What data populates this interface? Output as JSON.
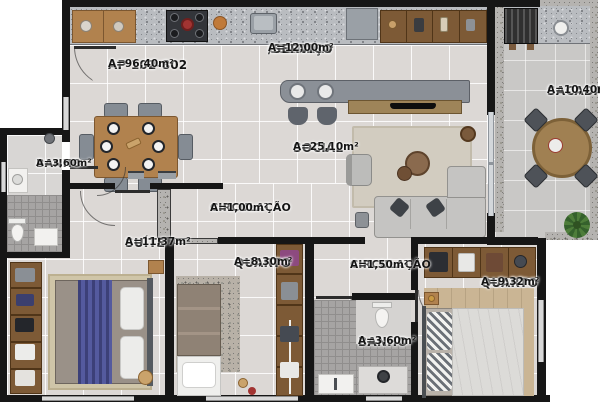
{
  "unit": {
    "code": "AP 102-802",
    "area": "A=96,40m²"
  },
  "rooms": {
    "cozinha": {
      "name": "COZINHA",
      "name2": "/SERVIÇO",
      "area": "A=12,00m²"
    },
    "social": {
      "name": "SOCIAL",
      "area": "A=25,10m²"
    },
    "sacada": {
      "name": "SACADA",
      "area": "A=10,40m²"
    },
    "banho_esq": {
      "name": "BANHO",
      "area": "A=3,60m²"
    },
    "circulacao1": {
      "name": "CIRCULAÇÃO",
      "area": "A=1,00m²"
    },
    "suite": {
      "name": "SUÍTE",
      "area": "A=11,37m²"
    },
    "quarto1": {
      "name": "QUARTO",
      "area": "A=8,30m²"
    },
    "circulacao2": {
      "name": "CIRCULAÇÃO",
      "area": "A=1,50m²"
    },
    "banho2": {
      "name": "BANHO",
      "area": "A=3,60m²"
    },
    "quarto2": {
      "name": "QUARTO",
      "area": "A=9,32m²"
    }
  },
  "colors": {
    "wall": "#161616",
    "floor_tile": "#dcd8d5",
    "balcony_tile": "#c9c8c6",
    "wood": "#b1824e",
    "bed_runner_blue": "#4b4f8e",
    "sofa_gray": "#c5c4c2",
    "plant_green": "#4e7d3a"
  }
}
